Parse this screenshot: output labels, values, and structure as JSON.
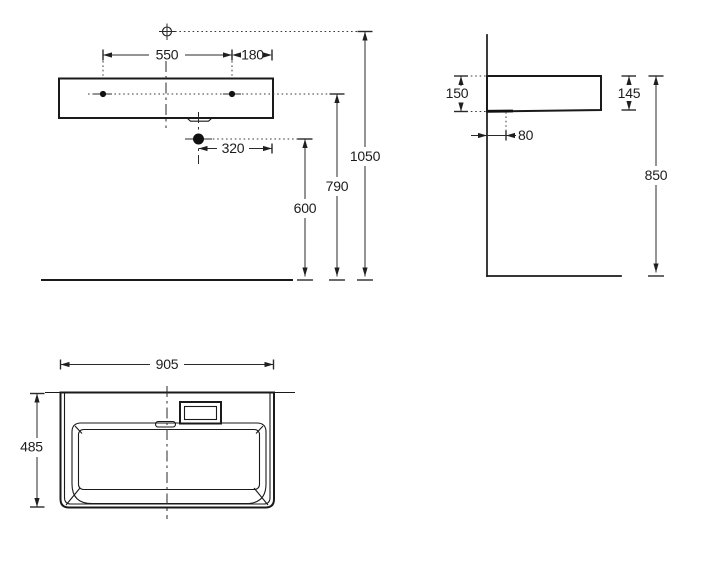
{
  "background": "#ffffff",
  "line_color": "#1a1a1a",
  "views": {
    "front": {
      "hole_spacing": "550",
      "hole_to_edge": "180",
      "drain_to_edge": "320",
      "drain_height": "600",
      "hole_height": "790",
      "mixer_height": "1050"
    },
    "side": {
      "depth_back": "150",
      "front_height": "145",
      "drain_offset": "80",
      "rim_height": "850"
    },
    "plan": {
      "width": "905",
      "depth": "485"
    }
  }
}
